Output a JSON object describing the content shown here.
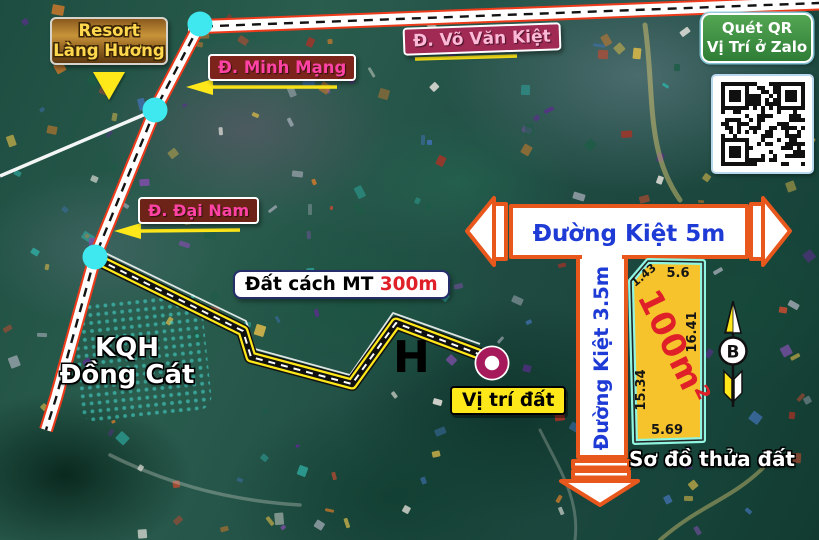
{
  "map": {
    "poi": {
      "resort": {
        "line1": "Resort",
        "line2": "Làng Hương"
      },
      "kqh": {
        "line1": "KQH",
        "line2": "Đồng Cát"
      },
      "h_mark": "H"
    },
    "roads": {
      "vo_van_kiet": "Đ. Võ Văn Kiệt",
      "minh_mang": "Đ. Minh Mạng",
      "dai_nam": "Đ. Đại Nam"
    },
    "distance_note": {
      "text": "Đất cách MT",
      "value": "300m"
    },
    "location_label": "Vị trí đất"
  },
  "qr_panel": {
    "line1": "Quét QR",
    "line2": "Vị Trí ở Zalo"
  },
  "diagram": {
    "alley_5m": "Đường Kiệt 5m",
    "alley_3_5m": "Đường Kiệt 3.5m",
    "caption": "Sơ đồ thửa đất",
    "plot": {
      "area": "100m²",
      "edges": {
        "top_left": "1.43",
        "top": "5.6",
        "right": "16.41",
        "left": "15.34",
        "bottom": "5.69"
      }
    },
    "compass_letter": "B"
  },
  "colors": {
    "road_edge": "#ee3b1b",
    "alley_border": "#e8571c",
    "accent_cyan": "#3fe8ee",
    "path_yellow": "#ffe81a",
    "plot_fill": "#f6c32c",
    "plot_border": "#8ff5e0",
    "area_red": "#e02028",
    "alley_text_blue": "#1f3bd6",
    "pink_label": "#ff43a5",
    "marker_ring": "#a6195b"
  }
}
